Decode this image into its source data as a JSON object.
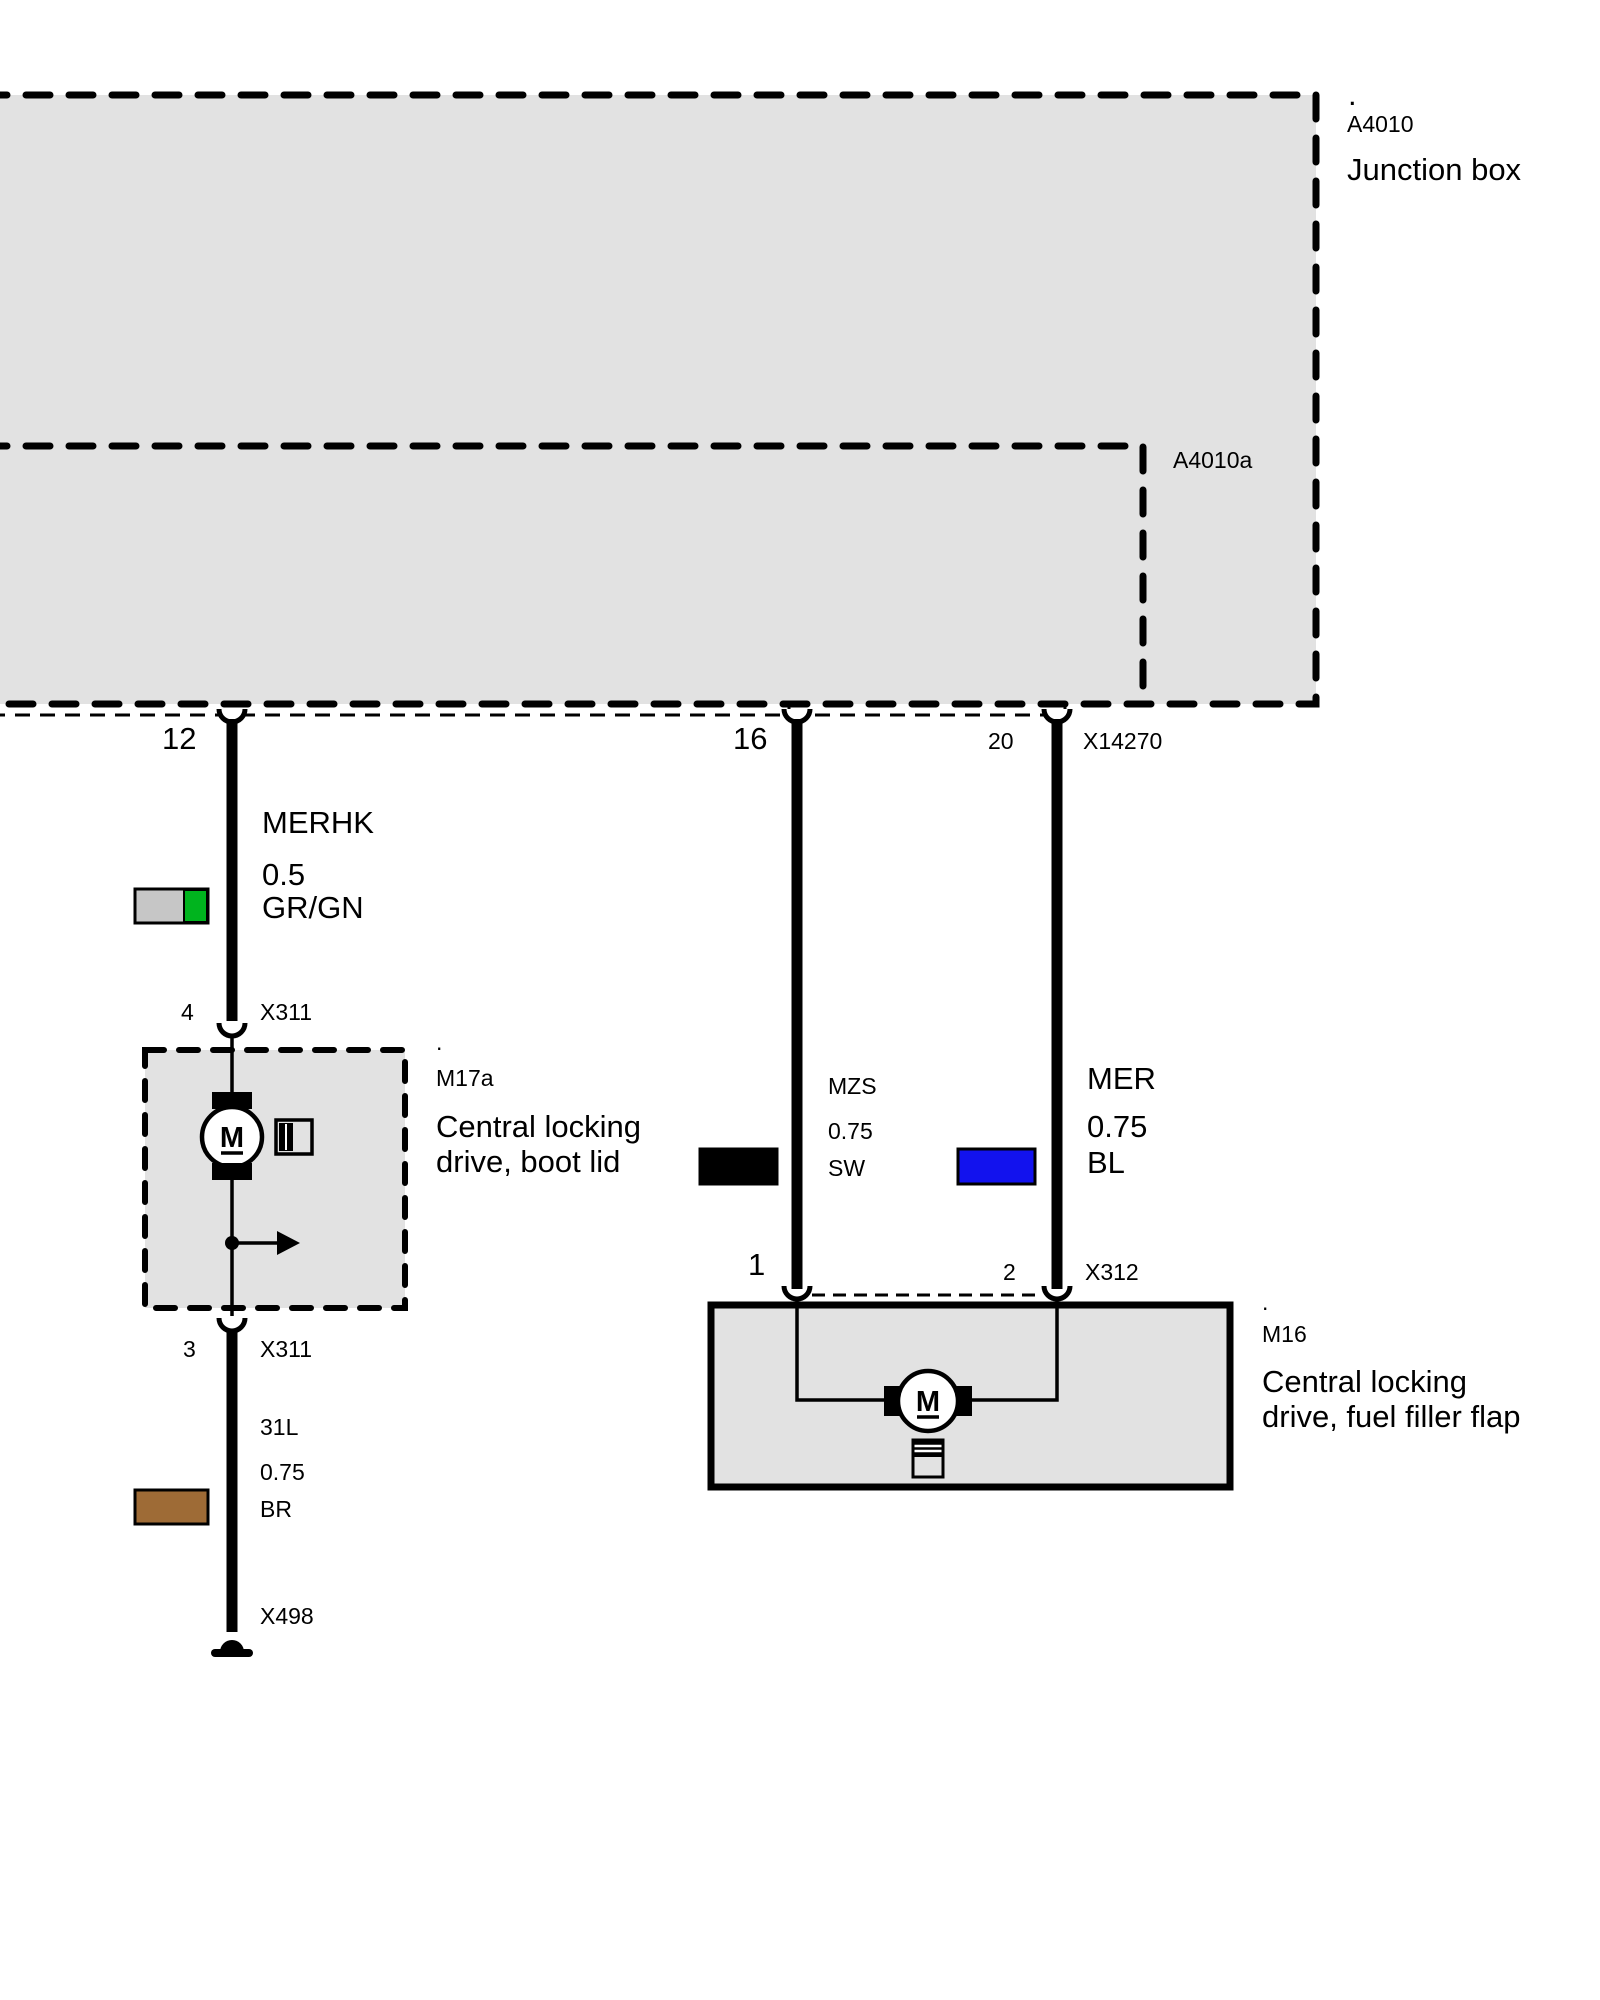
{
  "diagram": {
    "junction_box": {
      "dot": ".",
      "ref": "A4010",
      "label": "Junction box",
      "inner_ref": "A4010a",
      "pin_12": "12"
    },
    "connectors": {
      "x14270": {
        "pin_16": "16",
        "pin_20": "20",
        "name": "X14270"
      },
      "x311_top": {
        "pin": "4",
        "name": "X311"
      },
      "x311_bottom": {
        "pin": "3",
        "name": "X311"
      },
      "x312": {
        "pin_1": "1",
        "pin_2": "2",
        "name": "X312"
      },
      "x498": {
        "name": "X498"
      }
    },
    "wires": {
      "merhk": {
        "name": "MERHK",
        "gauge": "0.5",
        "color_code": "GR/GN"
      },
      "mzs": {
        "name": "MZS",
        "gauge": "0.75",
        "color_code": "SW"
      },
      "mer": {
        "name": "MER",
        "gauge": "0.75",
        "color_code": "BL"
      },
      "w31l": {
        "name": "31L",
        "gauge": "0.75",
        "color_code": "BR"
      }
    },
    "components": {
      "m17a": {
        "dot": ".",
        "ref": "M17a",
        "label_line1": "Central locking",
        "label_line2": "drive, boot lid",
        "motor": "M"
      },
      "m16": {
        "dot": ".",
        "ref": "M16",
        "label_line1": "Central locking",
        "label_line2": "drive, fuel filler flap",
        "motor": "M"
      }
    }
  },
  "colors": {
    "box_fill": "#e2e2e2",
    "line_black": "#000000",
    "swatch_gray": "#c6c6c6",
    "swatch_green": "#00b41e",
    "swatch_black": "#000000",
    "swatch_blue": "#1212ee",
    "swatch_brown": "#9e6b36"
  }
}
